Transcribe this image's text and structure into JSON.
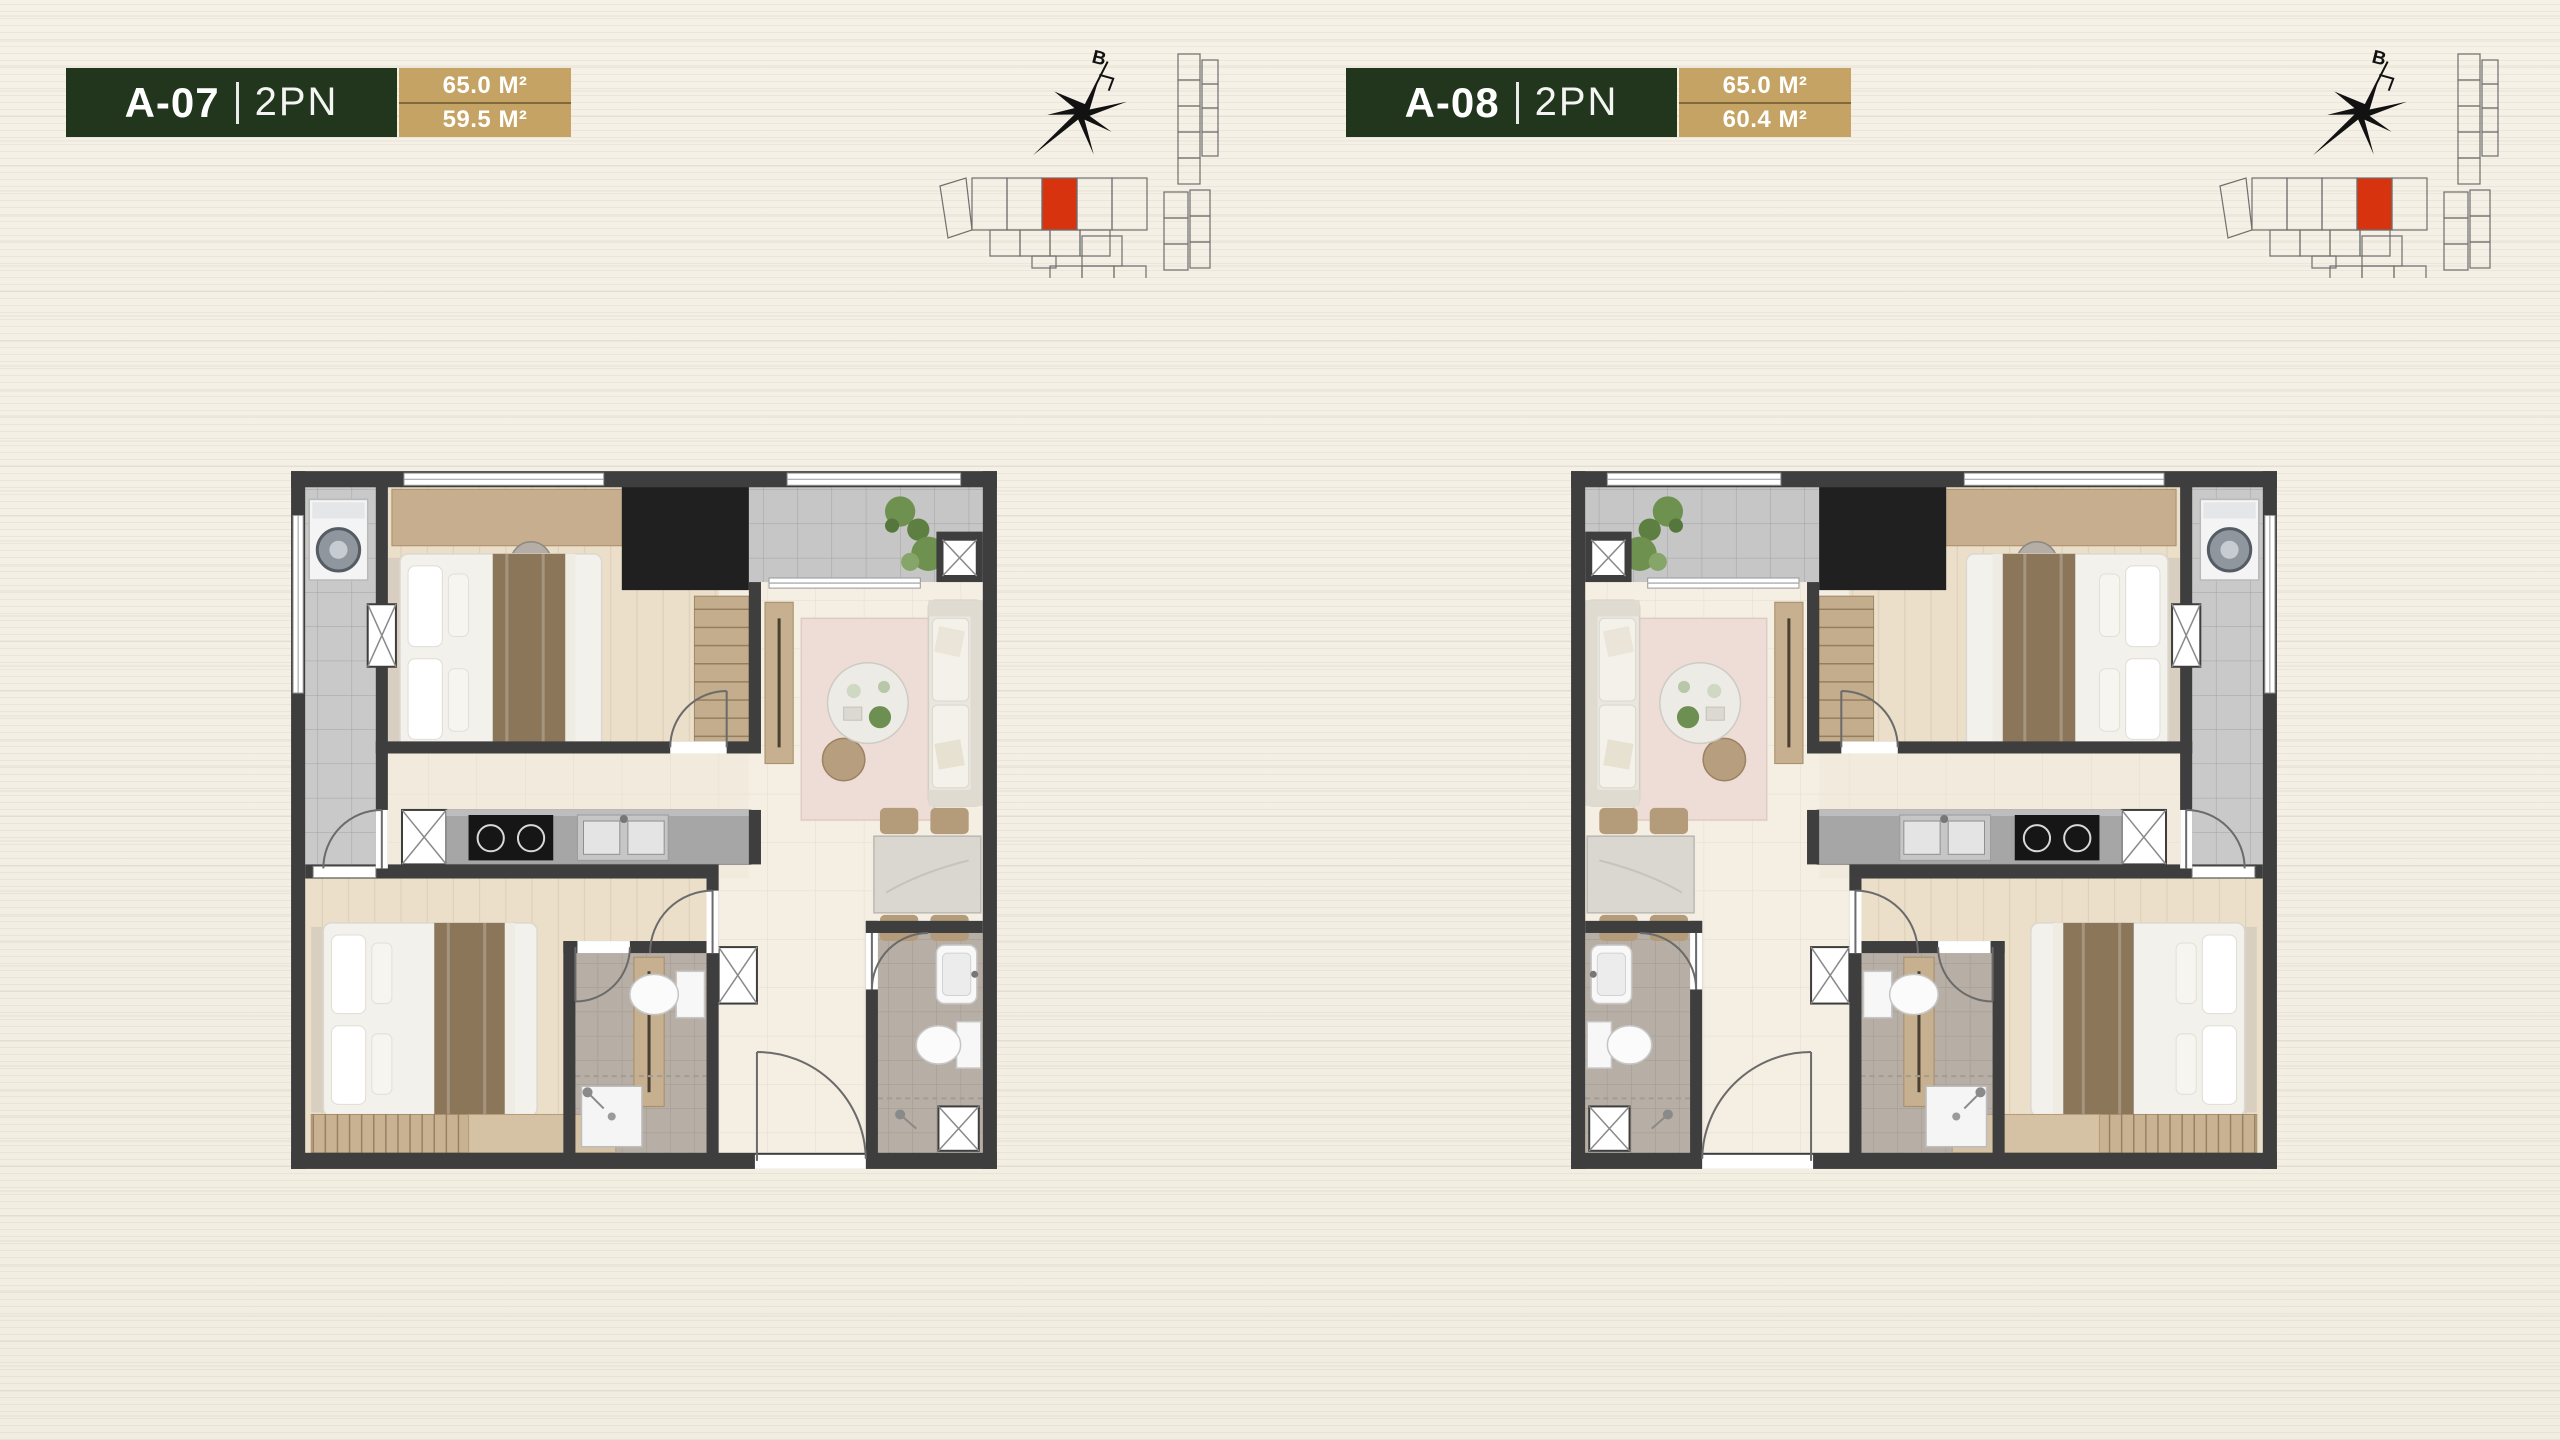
{
  "page": {
    "background_color": "#f3efe4"
  },
  "colors": {
    "chip_green": "#21361d",
    "chip_tan": "#c4a365",
    "keyplan_highlight_red": "#d6330e",
    "wall_gray": "#3e3e3e"
  },
  "units": [
    {
      "code": "A-07",
      "type": "2PN",
      "area_construction": "65.0 M²",
      "area_net": "59.5 M²",
      "compass_label": "B",
      "keyplan_red_x": "110"
    },
    {
      "code": "A-08",
      "type": "2PN",
      "area_construction": "65.0 M²",
      "area_net": "60.4 M²",
      "compass_label": "B",
      "keyplan_red_x": "145"
    }
  ]
}
